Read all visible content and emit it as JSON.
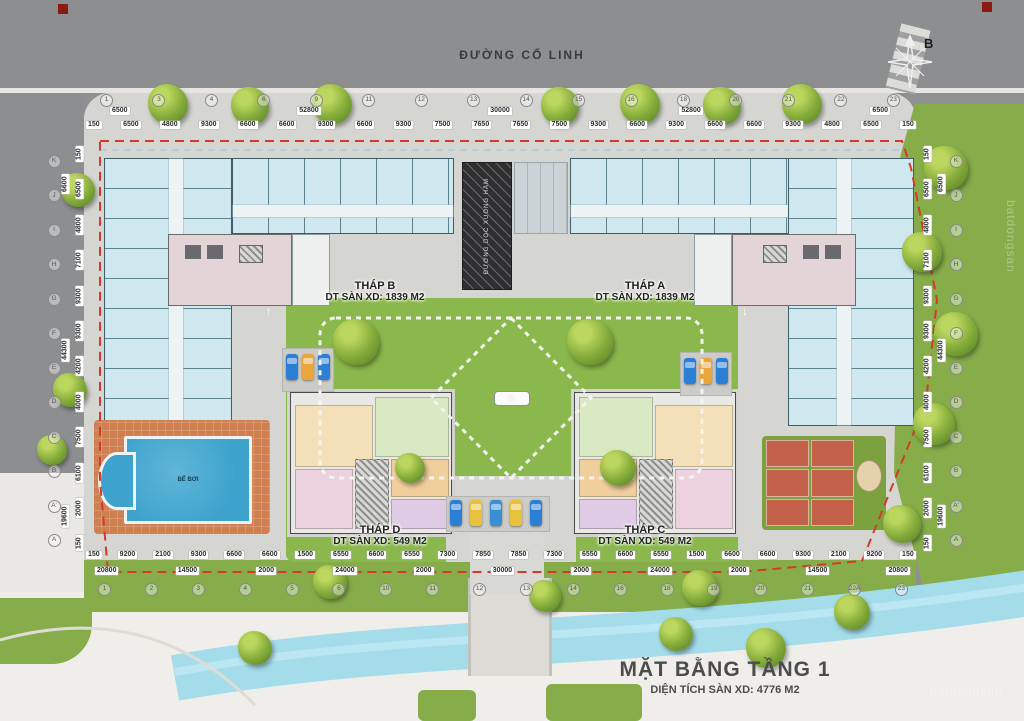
{
  "meta": {
    "road_name": "ĐƯỜNG CỔ LINH",
    "compass_label": "B",
    "watermark": "batdongsan"
  },
  "title_block": {
    "title": "MẶT BẰNG TẦNG 1",
    "subtitle": "DIỆN TÍCH SÀN XD: 4776 M2"
  },
  "towers": {
    "b": {
      "name": "THÁP B",
      "area": "DT SÀN XD: 1839 M2"
    },
    "a": {
      "name": "THÁP A",
      "area": "DT SÀN XD: 1839 M2"
    },
    "d": {
      "name": "THÁP D",
      "area": "DT SÀN XD: 549 M2"
    },
    "c": {
      "name": "THÁP C",
      "area": "DT SÀN XD: 549 M2"
    }
  },
  "ramp_label": "ĐƯỜNG DỐC XUỐNG HẦM",
  "pool_label": "BỂ BƠI",
  "dimensions": {
    "top_overall": [
      "6500",
      "52800",
      "30000",
      "52800",
      "6500"
    ],
    "top_detail": [
      "150",
      "6500",
      "4800",
      "9300",
      "6600",
      "6600",
      "9300",
      "6600",
      "9300",
      "7500",
      "7650",
      "7650",
      "7500",
      "9300",
      "6600",
      "9300",
      "6600",
      "6600",
      "9300",
      "4800",
      "6500",
      "150"
    ],
    "bottom_detail": [
      "150",
      "9200",
      "2100",
      "9300",
      "6600",
      "6600",
      "1500",
      "6550",
      "6600",
      "6550",
      "7300",
      "7850",
      "7850",
      "7300",
      "6550",
      "6600",
      "6550",
      "1500",
      "6600",
      "6600",
      "9300",
      "2100",
      "9200",
      "150"
    ],
    "bottom_overall": [
      "20800",
      "14500",
      "2000",
      "24000",
      "2000",
      "30000",
      "2000",
      "24000",
      "2000",
      "14500",
      "20800"
    ],
    "left_overall": [
      "6600",
      "44300",
      "19600"
    ],
    "left_detail": [
      "150",
      "6500",
      "4800",
      "7100",
      "9300",
      "9300",
      "4200",
      "4000",
      "7500",
      "6100",
      "2000",
      "150"
    ],
    "right_overall": [
      "6500",
      "44300",
      "19600"
    ],
    "right_detail": [
      "150",
      "6500",
      "4800",
      "7100",
      "9300",
      "9300",
      "4200",
      "4000",
      "7500",
      "6100",
      "2000",
      "150"
    ]
  },
  "grid_bubbles": {
    "top": [
      "1",
      "3",
      "4",
      "6",
      "9",
      "11",
      "12",
      "13",
      "14",
      "15",
      "16",
      "18",
      "20",
      "21",
      "22",
      "23"
    ],
    "bottom": [
      "1",
      "2",
      "3",
      "4",
      "5",
      "6",
      "10",
      "11",
      "12",
      "13",
      "14",
      "16",
      "18",
      "19",
      "20",
      "21",
      "22A",
      "23"
    ],
    "left": [
      "K",
      "J",
      "I",
      "H",
      "G",
      "F",
      "E",
      "D",
      "C",
      "B",
      "A'",
      "A"
    ],
    "right": [
      "K",
      "J",
      "I",
      "H",
      "G",
      "F",
      "E",
      "D",
      "C",
      "B",
      "A'",
      "A"
    ]
  },
  "colors": {
    "boundary_red": "#d43a2a",
    "unit_blue": "#cfe8f0",
    "lawn_green": "#8ab84c",
    "pool_blue": "#3da2cc",
    "deck_orange": "#cf7f50",
    "canal_blue": "#a5dcea",
    "court_red": "#c4614a",
    "road_gray": "#8f9092"
  }
}
